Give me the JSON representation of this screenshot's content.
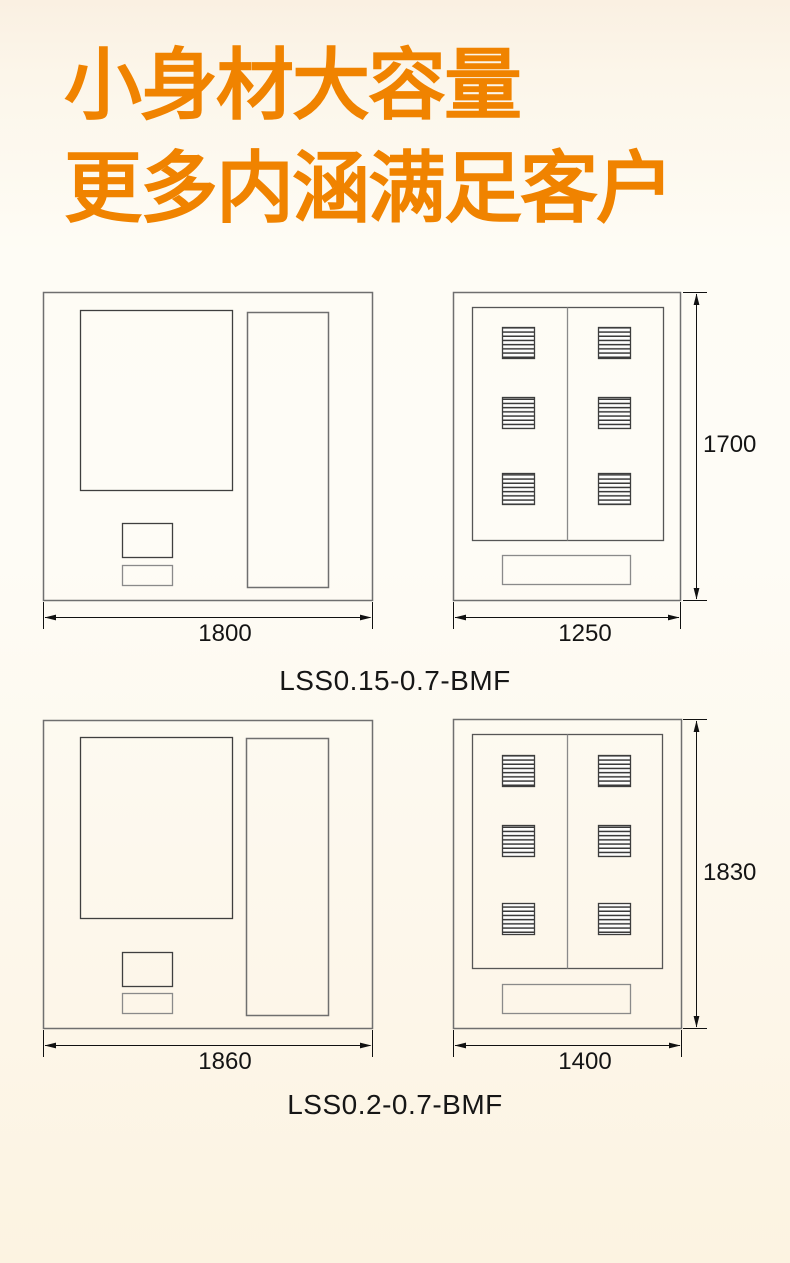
{
  "header": {
    "line1": "小身材大容量",
    "line2": "更多内涵满足客户",
    "accent_color": "#F08300",
    "text_color": "#161616"
  },
  "figures": [
    {
      "model": "LSS0.15-0.7-BMF",
      "front": {
        "width_label": "1800"
      },
      "side": {
        "width_label": "1250",
        "height_label": "1700"
      }
    },
    {
      "model": "LSS0.2-0.7-BMF",
      "front": {
        "width_label": "1860"
      },
      "side": {
        "width_label": "1400",
        "height_label": "1830"
      }
    }
  ]
}
